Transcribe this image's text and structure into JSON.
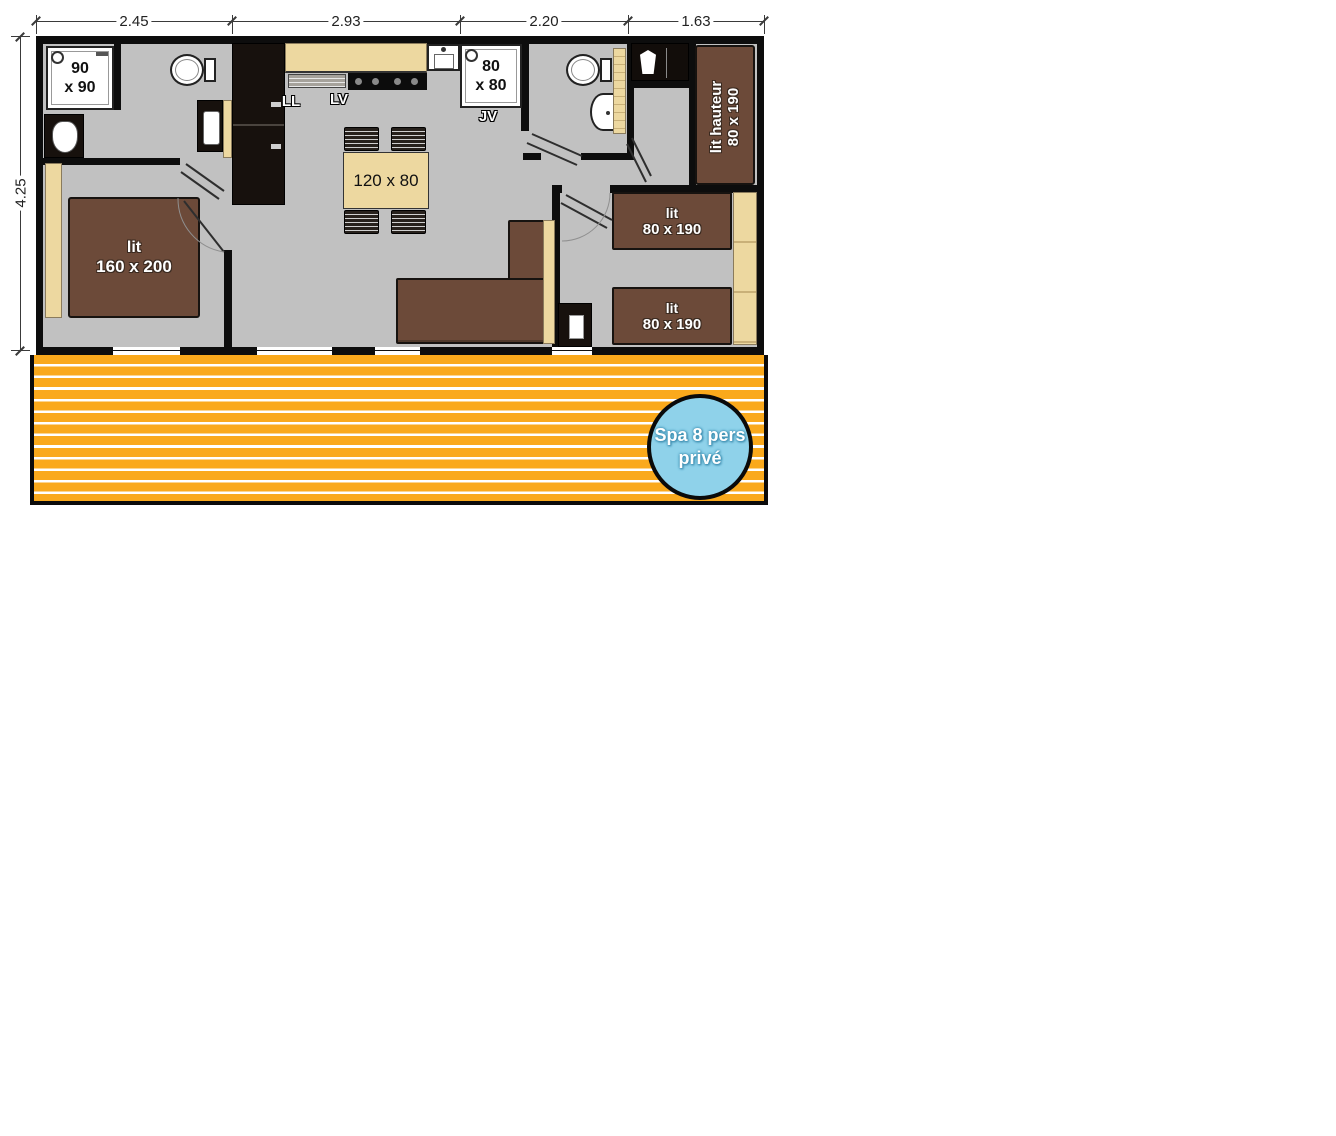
{
  "dimensions": {
    "top": [
      "2.45",
      "2.93",
      "2.20",
      "1.63"
    ],
    "left": "4.25"
  },
  "labels": {
    "shower_left": {
      "line1": "90",
      "line2": "x 90"
    },
    "shower_right": {
      "line1": "80",
      "line2": "x 80"
    },
    "washer": "LL",
    "dishwasher": "LV",
    "jv": "JV",
    "table": "120 x 80",
    "bed_master": {
      "line1": "lit",
      "line2": "160 x 200"
    },
    "bed_high": {
      "line1": "lit hauteur",
      "line2": "80 x 190"
    },
    "bed_single_1": {
      "line1": "lit",
      "line2": "80 x 190"
    },
    "bed_single_2": {
      "line1": "lit",
      "line2": "80 x 190"
    },
    "spa": {
      "line1": "Spa 8 pers",
      "line2": "privé"
    }
  },
  "colors": {
    "wall_black": "#0d0d0d",
    "floor": "#C1C1C1",
    "furniture_beige": "#EDD8A0",
    "bed_brown": "#6C4A39",
    "terrace_orange": "#FAA91C",
    "spa_blue": "#8FD2EA"
  }
}
